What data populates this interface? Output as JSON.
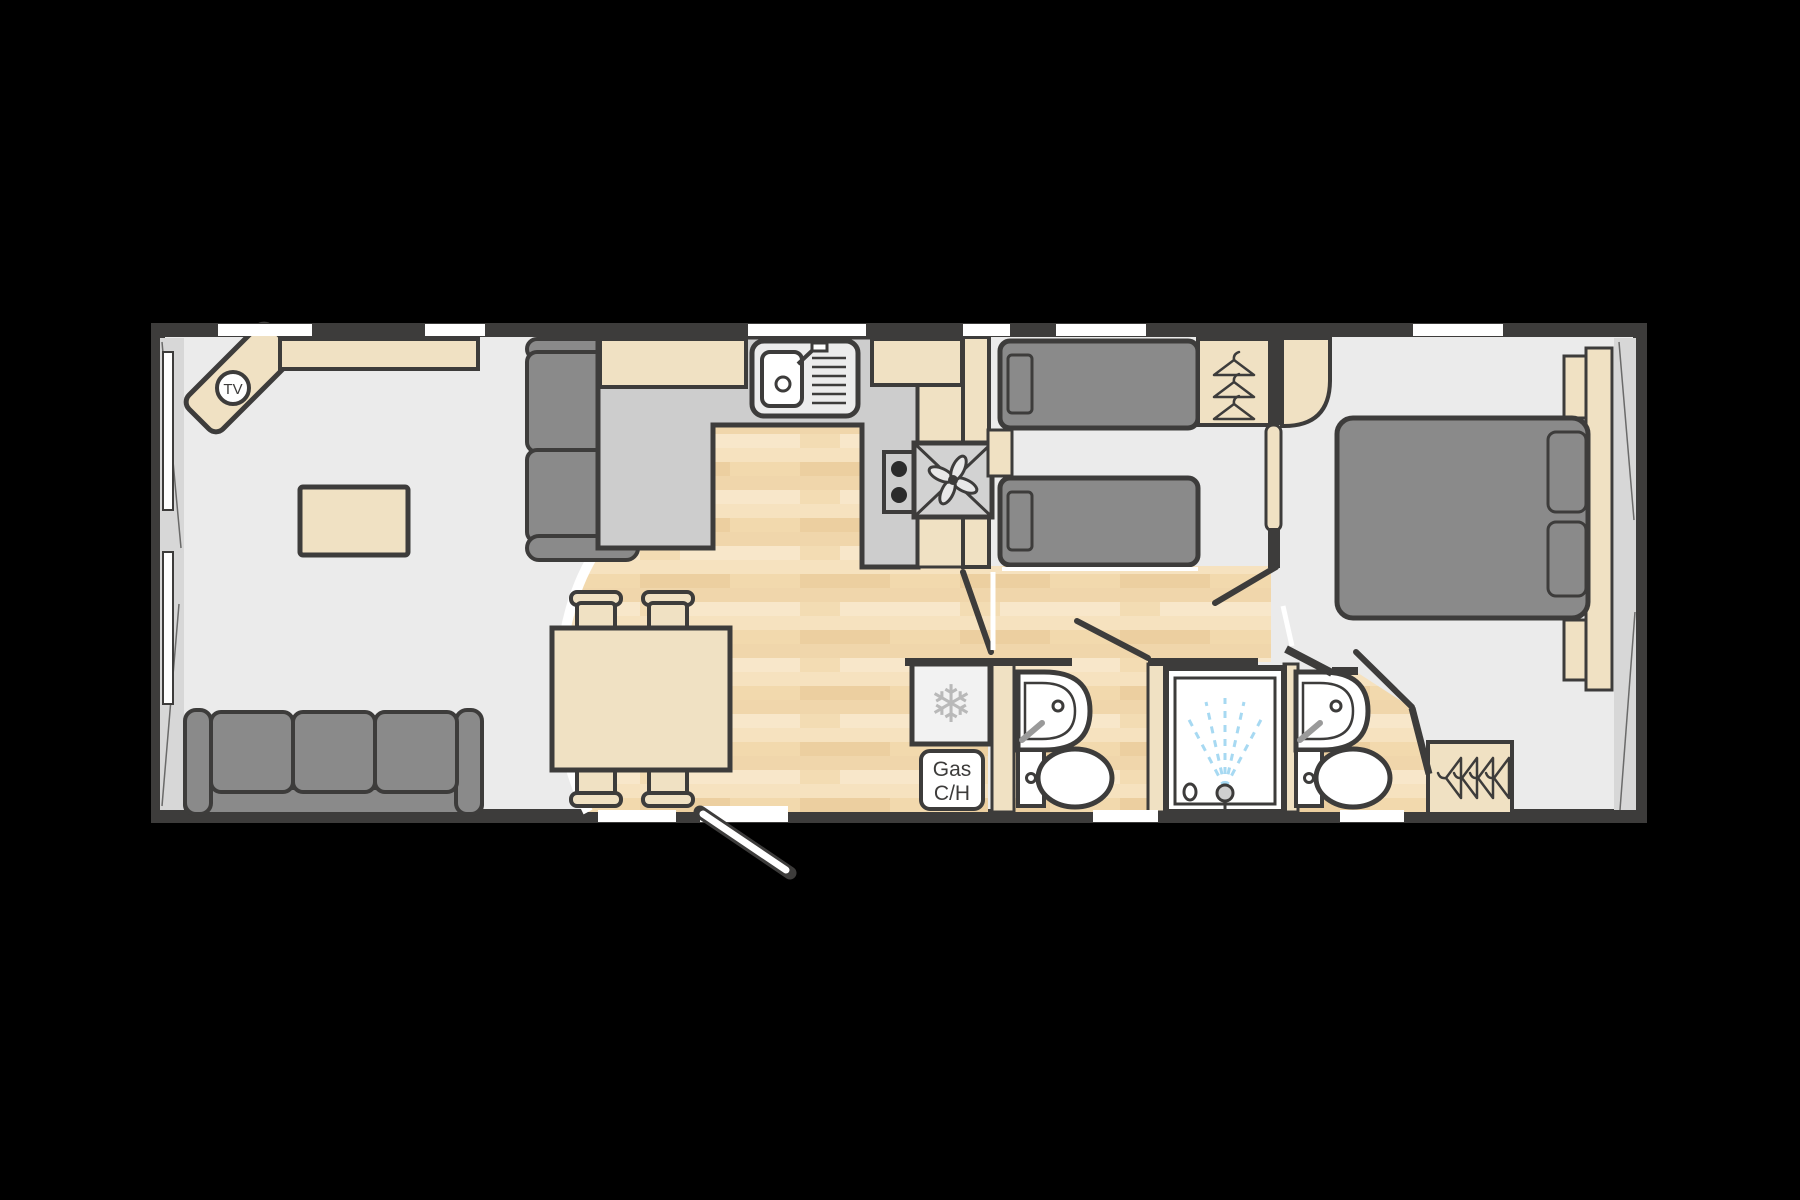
{
  "floorplan": {
    "labels": {
      "tv": "TV",
      "gas_line1": "Gas",
      "gas_line2": "C/H"
    },
    "icons": {
      "snowflake": "❄"
    },
    "colors": {
      "background": "#000000",
      "wall": "#3d3c3b",
      "floor": "#ebebeb",
      "wood": "#f3dcb3",
      "wood_dark": "#eccfa0",
      "wood_light": "#f7e4c4",
      "furniture_grey": "#8a8a8a",
      "counter_grey": "#cdcdcd",
      "beige": "#f0e1c3",
      "white": "#ffffff",
      "shower_spray_blue": "#a7d9f2",
      "snowflake_grey": "#b9b9b9"
    }
  }
}
